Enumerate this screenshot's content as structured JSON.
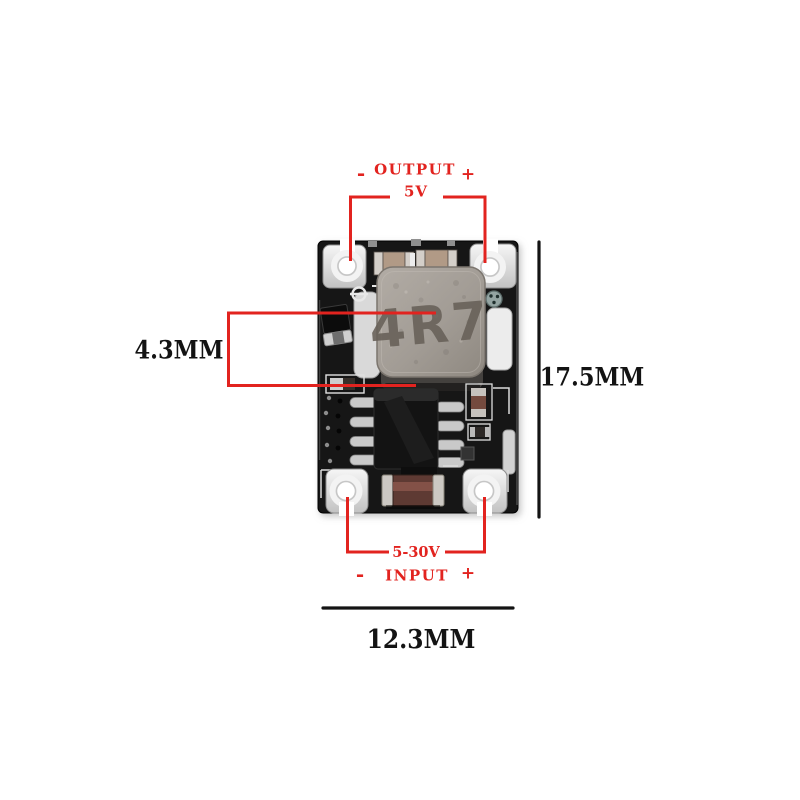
{
  "colors": {
    "annotation-red": "#e2231f",
    "dim-black": "#131313",
    "background": "#ffffff"
  },
  "annotations": {
    "output": {
      "label": "OUTPUT",
      "voltage": "5V",
      "minus": "-",
      "plus": "+"
    },
    "input": {
      "voltage": "5-30V",
      "label": "INPUT",
      "minus": "-",
      "plus": "+"
    },
    "dimensions": {
      "inductor_width": "4.3MM",
      "board_height": "17.5MM",
      "board_width": "12.3MM"
    }
  },
  "board": {
    "inductor_marking": "4R7"
  }
}
